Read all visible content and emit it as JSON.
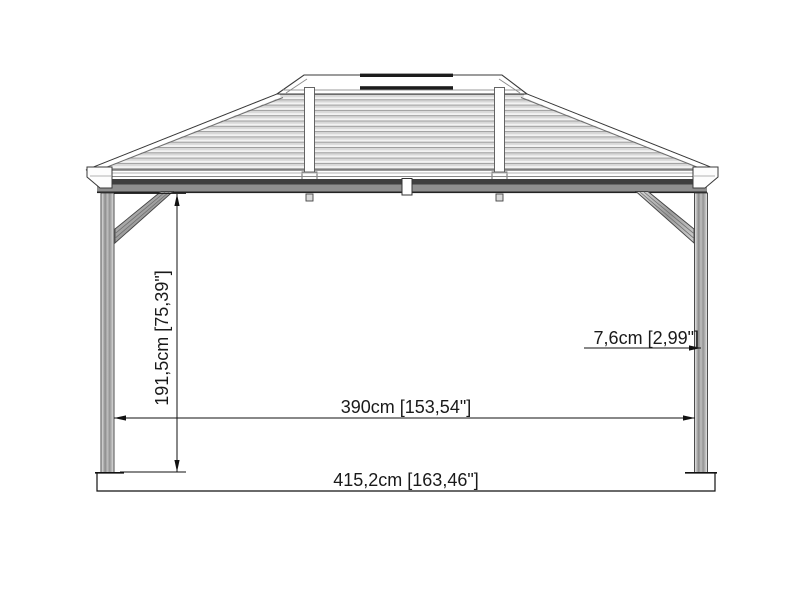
{
  "drawing": {
    "name": "Gazebo side elevation technical drawing",
    "dimensions": {
      "height": "191,5cm [75,39\"]",
      "post_to_post_width": "390cm [153,54\"]",
      "post_thickness": "7,6cm [2,99\"]",
      "overall_width": "415,2cm [163,46\"]"
    },
    "colors": {
      "background": "#ffffff",
      "outline": "#3a3a3a",
      "dimension_line": "#111111",
      "dimension_text": "#1a1a1a",
      "roof_slat_light": "#f3f3f3",
      "roof_slat_mid": "#d8d8d8",
      "roof_slat_line": "#9c9c9c",
      "beam_dark_band": "#3f3f3f",
      "beam_gray_band": "#8f8f8f",
      "vent_bar": "#1c1c1c",
      "post_gray": "#a8a8a8"
    }
  }
}
